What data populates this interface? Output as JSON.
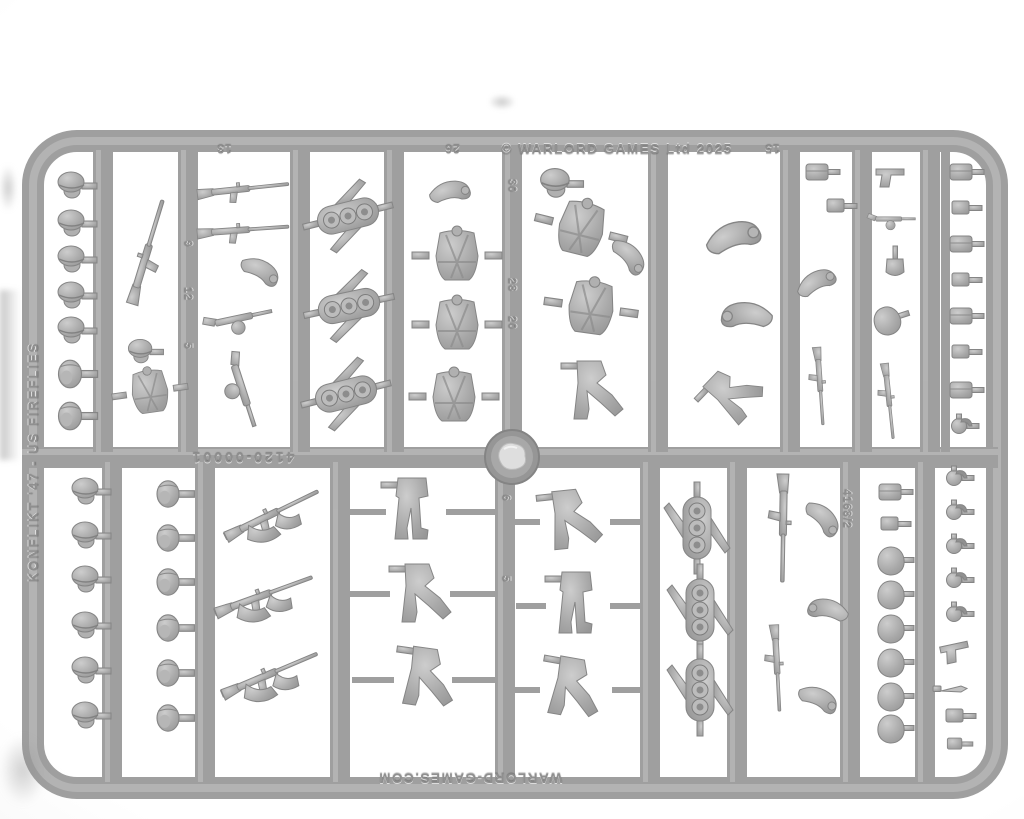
{
  "scene": {
    "type": "photograph",
    "subject": "grey plastic injection-moulded sprue of wargaming miniature parts on a white background"
  },
  "sprue": {
    "top_rail": {
      "copyright": "© WARLORD GAMES Ltd 2025",
      "numbers": [
        "13",
        "26",
        "15"
      ]
    },
    "left_rail": {
      "label": "KONFLIKT '47 - US FIREFLIES"
    },
    "center_rail": {
      "part_code": "4120-00001"
    },
    "bottom_rail": {
      "website": "WARLORD-GAMES.COM"
    },
    "bar_numbers": {
      "weapons_bar": [
        "9",
        "12",
        "5"
      ],
      "torso_bar": [
        "30",
        "28",
        "20"
      ],
      "legs_bar": [
        "6",
        "5"
      ],
      "mould_code": "4168/2"
    },
    "colors": {
      "plastic": "#9f9f9f",
      "plastic_highlight": "#b6b6b6",
      "plastic_shadow": "#858585",
      "background": "#ffffff"
    },
    "contents": {
      "heads_helmeted": 11,
      "heads_bare": 8,
      "rocket_packs": 6,
      "armoured_torsos": 5,
      "leg_pairs": 6,
      "arm_pairs_with_weapons": 3,
      "rifles_and_smgs": 10,
      "pistols": 2,
      "grenades": 6,
      "pouches_and_kit": 20,
      "injection_gate": 1
    }
  }
}
